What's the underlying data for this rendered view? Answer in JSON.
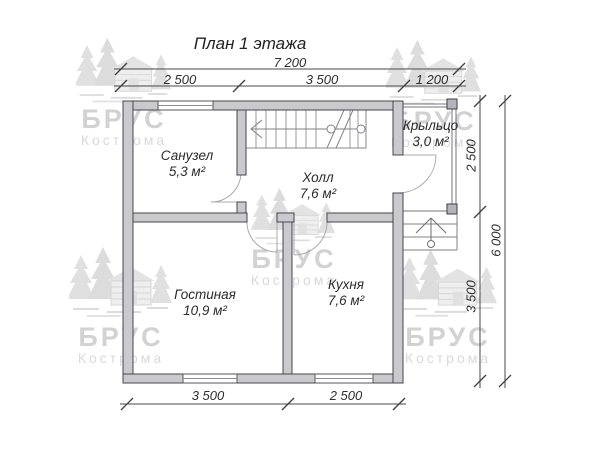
{
  "title": "План 1 этажа",
  "watermark": {
    "brand": "БРУС",
    "city": "Кострома"
  },
  "icons": {
    "watermark": "pine-trees-and-log-cabin"
  },
  "rooms": {
    "sanuzel": {
      "name": "Санузел",
      "area": "5,3 м²"
    },
    "hall": {
      "name": "Холл",
      "area": "7,6 м²"
    },
    "porch": {
      "name": "Крыльцо",
      "area": "3,0 м²"
    },
    "living": {
      "name": "Гостиная",
      "area": "10,9 м²"
    },
    "kitchen": {
      "name": "Кухня",
      "area": "7,6 м²"
    }
  },
  "dimensions": {
    "top_total": "7 200",
    "top_segments": [
      "2 500",
      "3 500",
      "1 200"
    ],
    "right_segments": [
      "2 500",
      "3 500"
    ],
    "right_total": "6 000",
    "bottom_segments": [
      "3 500",
      "2 500"
    ]
  },
  "colors": {
    "wall_fill": "#cacace",
    "wall_outline": "#45454d",
    "thin_line": "#80808a",
    "dimension": "#4a4a4a",
    "watermark": "#d6d6d6"
  }
}
